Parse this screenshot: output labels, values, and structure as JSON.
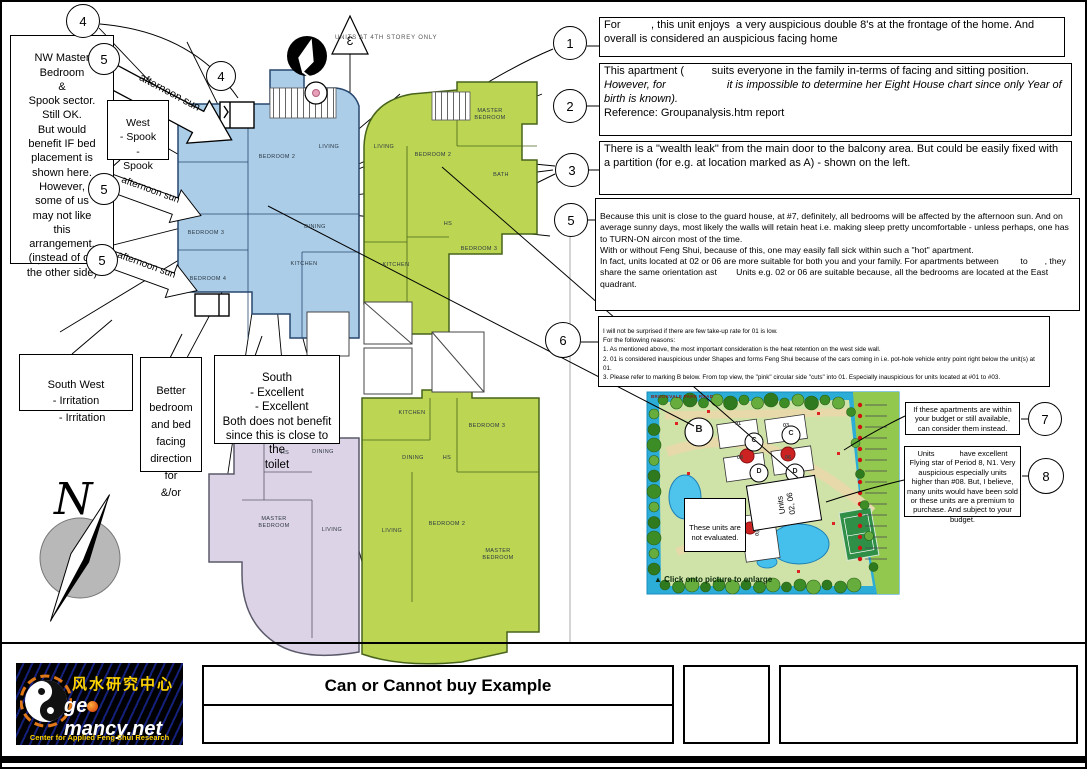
{
  "callouts": {
    "one": "1",
    "two": "2",
    "three": "3",
    "four": "4",
    "five": "5",
    "six": "6",
    "seven": "7",
    "eight": "8"
  },
  "notes": {
    "n1": "For          , this unit enjoys  a very auspicious double 8's at the frontage of the home. And overall is considered an auspicious facing home",
    "n2_pre": "This apartment (         suits everyone in the family in-terms of facing and sitting position. ",
    "n2_italic": "However, for                    it is impossible to determine her Eight House chart since only Year of birth is known).",
    "n2_post": "Reference: Groupanalysis.htm report",
    "n3": "There is a \"wealth leak\" from the main door to the balcony area. But could be easily fixed with a partition (for e.g. at location marked as A) - shown on the left.",
    "n5": "Because this unit is close to the guard house, at #7, definitely, all bedrooms will be affected by the afternoon sun. And on average sunny days, most likely the walls will retain heat i.e. making sleep pretty uncomfortable - unless perhaps, one has to TURN-ON aircon most of the time.\nWith or without Feng Shui, because of this, one may easily fall sick within such a \"hot\" apartment.\nIn fact, units located at 02 or 06 are more suitable for both you and your family. For apartments between         to       , they share the same orientation ast        Units e.g. 02 or 06 are suitable because, all the bedrooms are located at the East quadrant.",
    "n6": "I will not be surprised if there are few take-up rate for 01 is low.\nFor the following reasons:\n1. As mentioned above, the most important consideration is the heat retention on the west side wall.\n2. 01 is considered inauspicious under Shapes and forms Feng Shui because of the cars coming in i.e. pot-hole vehicle entry point right below the unit(s) at 01.\n3. Please refer to marking B below. From top view, the \"pink\" circular side \"cuts\" into 01. Especially inauspicious for units located at #01 to #03.",
    "n7": "If these apartments are within your budget or still available, can consider them instead.",
    "n8": "Units            have excellent Flying star of Period 8, N1. Very auspicious especially units higher than #08. But, I believe, many units would have been sold or these units are a premium to purchase. And subject to your budget.",
    "nw": "NW Master\nBedroom\n&\nSpook sector.\nStill OK.\nBut would\nbenefit IF bed\nplacement is\nshown here.\nHowever,\nsome of us\nmay not like\nthis\narrangement.\n(instead of on\nthe other side)",
    "west": "West\n- Spook\n-\nSpook",
    "southwest": "South West\n- Irritation\n    - Irritation",
    "better": "Better\nbedroom\nand bed\nfacing\ndirection for\n&/or",
    "south": "South\n- Excellent\n   - Excellent\nBoth does not benefit\nsince this is close to the\ntoilet",
    "afternoon": "afternoon sun"
  },
  "plan": {
    "storey_note": "UNITS AT 4TH STOREY ONLY",
    "triangle_label": "3",
    "north": "N",
    "blue": {
      "bedroom2": "BEDROOM 2",
      "living": "LIVING",
      "dining": "DINING",
      "kitchen": "KITCHEN",
      "bedroom3": "BEDROOM 3",
      "bedroom4": "BEDROOM 4"
    },
    "green_top": {
      "master": "MASTER\nBEDROOM",
      "living": "LIVING",
      "bedroom2": "BEDROOM 2",
      "bath": "BATH",
      "hs": "HS",
      "bedroom3": "BEDROOM 3",
      "kitchen": "KITCHEN"
    },
    "lavender": {
      "dining": "DINING",
      "hs": "HS",
      "master": "MASTER\nBEDROOM",
      "living": "LIVING"
    },
    "green_bottom": {
      "kitchen": "KITCHEN",
      "dining": "DINING",
      "hs": "HS",
      "bedroom3": "BEDROOM 3",
      "bedroom2": "BEDROOM 2",
      "living": "LIVING",
      "master": "MASTER\nBEDROOM"
    }
  },
  "map": {
    "road_label": "BROOKVALE PARK ROAD",
    "marker_b": "B",
    "marker_c": "C",
    "marker_d": "D",
    "unit_01": "01",
    "unit_03": "03",
    "unit_04": "04",
    "unit_06": "06",
    "unit_05": "05",
    "note": "These units are\nnot evaluated.",
    "units_box_line1": "Units",
    "units_box_line2": "02, 06",
    "click_icon": "▲",
    "click_text": "Click onto picture to enlarge"
  },
  "title_block": {
    "title": "Can or Cannot buy Example",
    "logo_chinese": "风水研究中心",
    "logo_domain_pre": "ge",
    "logo_domain_post": "mancy.net",
    "logo_tagline": "Center for Applied Feng Shui Research"
  }
}
